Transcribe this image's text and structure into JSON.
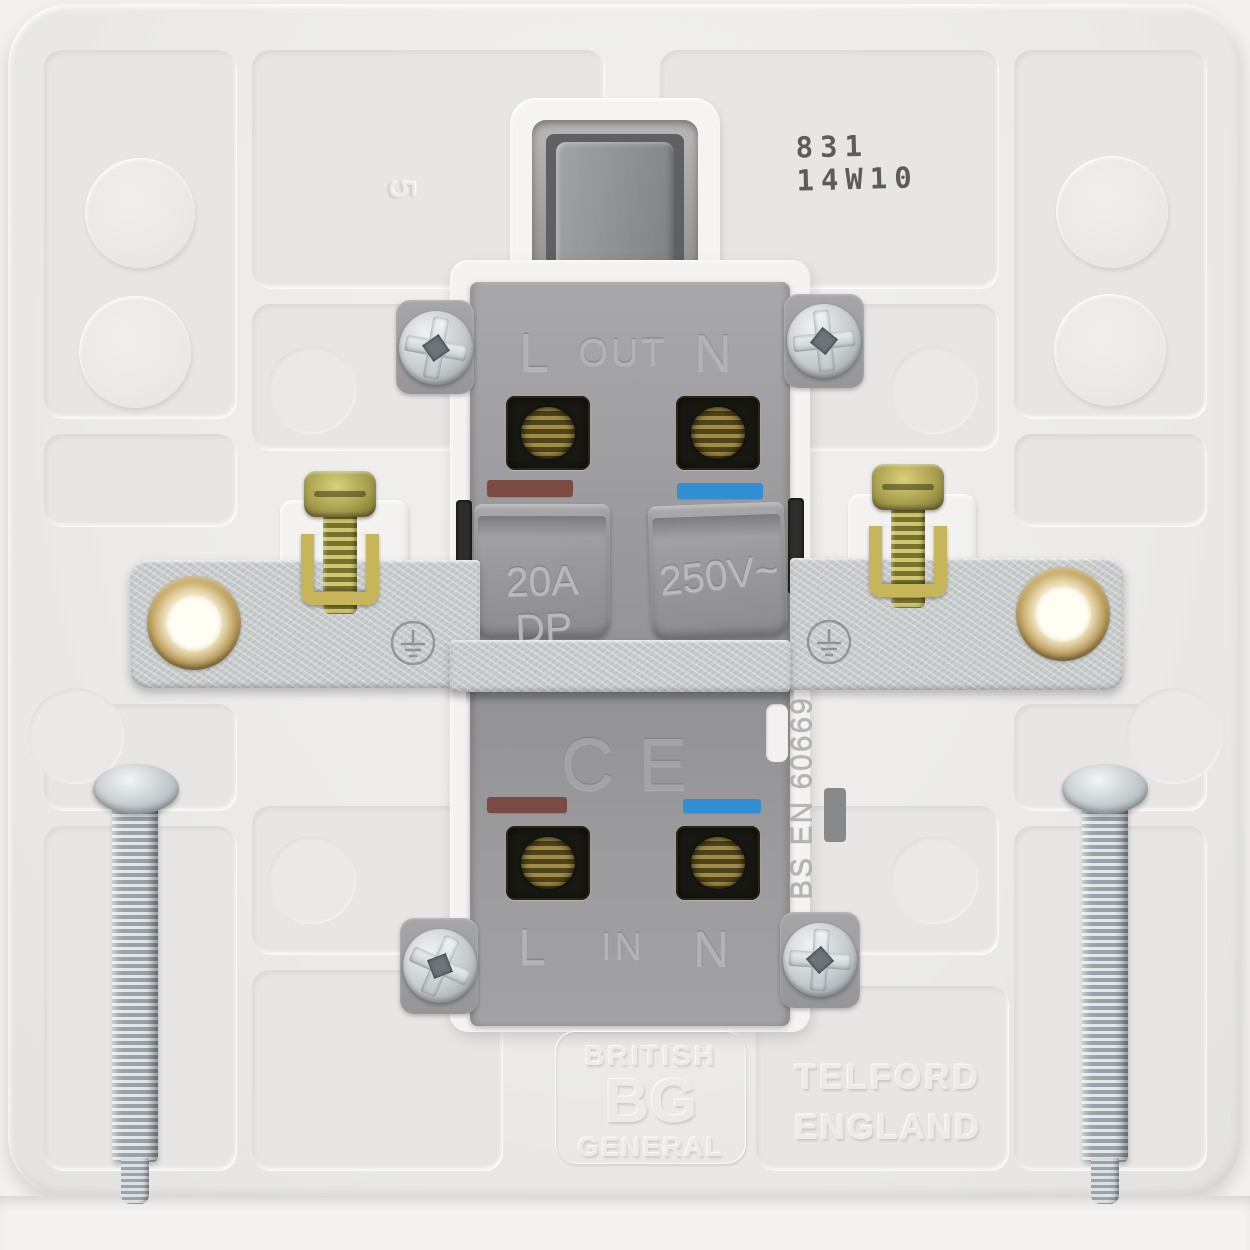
{
  "image": {
    "type": "product_photo",
    "subject": "Rear view of a white moulded BG (British General) 20A double-pole switch showing terminals, mounting yoke, earth terminals and fixing screws"
  },
  "batch_stamp": {
    "line1": "831",
    "line2": "14W10",
    "ink_color": "#4b4a45"
  },
  "mould": {
    "cavity_number": "5"
  },
  "mechanism": {
    "top_row": {
      "live": "L",
      "direction": "OUT",
      "neutral": "N"
    },
    "bottom_row": {
      "live": "L",
      "direction": "IN",
      "neutral": "N"
    },
    "rating_current": "20A DP",
    "rating_voltage": "250V~",
    "ce_mark": "CE",
    "standard": "BS EN 60669",
    "body_color": "#9a9a9c",
    "live_marker_color": "#7b4b43",
    "neutral_marker_color": "#2f8fd2"
  },
  "embossed_branding": {
    "brand_line1": "BRITISH",
    "brand_initials": "BG",
    "brand_line2": "GENERAL",
    "origin_line1": "TELFORD",
    "origin_line2": "ENGLAND"
  },
  "hardware_colors": {
    "plate": "#edecea",
    "yoke": "#c8cbcc",
    "brass_insert": "#b18d3e",
    "terminal_screw": "#8f813f",
    "fixing_screw": "#c3c9cd"
  }
}
